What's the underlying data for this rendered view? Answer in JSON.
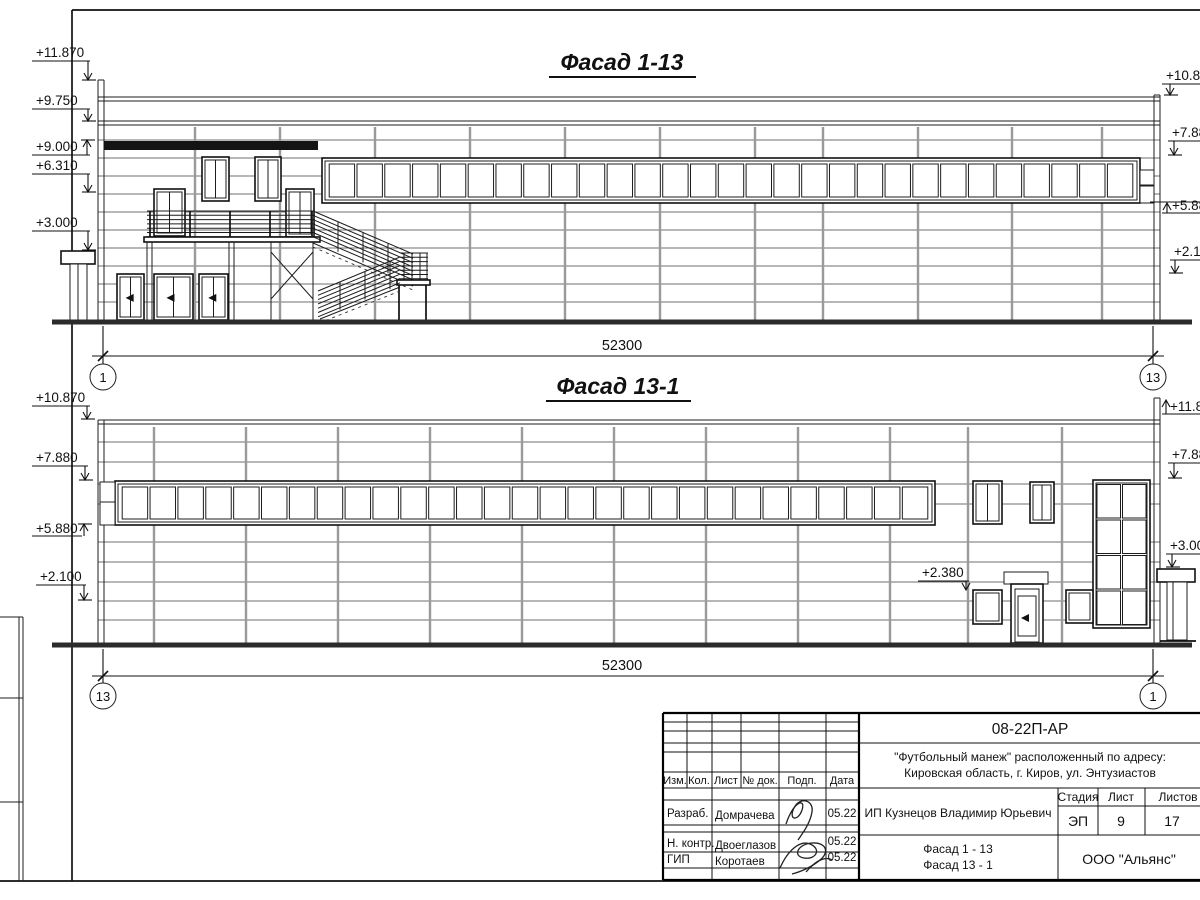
{
  "f1": {
    "title": "Фасад 1-13",
    "elevations_left": [
      "+11.870",
      "+9.750",
      "+9.000",
      "+6.310",
      "+3.000"
    ],
    "elevations_right": [
      "+10.870",
      "+7.880",
      "+5.880",
      "+2.100"
    ],
    "dimension": "52300",
    "axis_left": "1",
    "axis_right": "13"
  },
  "f2": {
    "title": "Фасад 13-1",
    "elevations_left": [
      "+10.870",
      "+7.880",
      "+5.880",
      "+2.100"
    ],
    "elevations_right": [
      "+11.870",
      "+7.880",
      "+3.000"
    ],
    "annotation": "+2.380",
    "dimension": "52300",
    "axis_left": "13",
    "axis_right": "1"
  },
  "title_block": {
    "doc_number": "08-22П-АР",
    "project_line1": "\"Футбольный манеж\" расположенный по адресу:",
    "project_line2": "Кировская область, г. Киров, ул. Энтузиастов",
    "columns": {
      "izm": "Изм.",
      "kol": "Кол.",
      "list": "Лист",
      "doc": "№ док.",
      "podp": "Подп.",
      "data": "Дата"
    },
    "rows": [
      {
        "role": "Разраб.",
        "name": "Домрачева",
        "date": "05.22"
      },
      {
        "role": "Н. контр.",
        "name": "Двоеглазов",
        "date": "05.22"
      },
      {
        "role": "ГИП",
        "name": "Коротаев",
        "date": "05.22"
      }
    ],
    "client": "ИП Кузнецов Владимир Юрьевич",
    "stage_label": "Стадия",
    "sheet_label": "Лист",
    "sheets_label": "Листов",
    "stage": "ЭП",
    "sheet_no": "9",
    "sheets_total": "17",
    "drawing_name_line1": "Фасад 1 - 13",
    "drawing_name_line2": "Фасад 13 - 1",
    "company": "ООО \"Альянс\""
  }
}
